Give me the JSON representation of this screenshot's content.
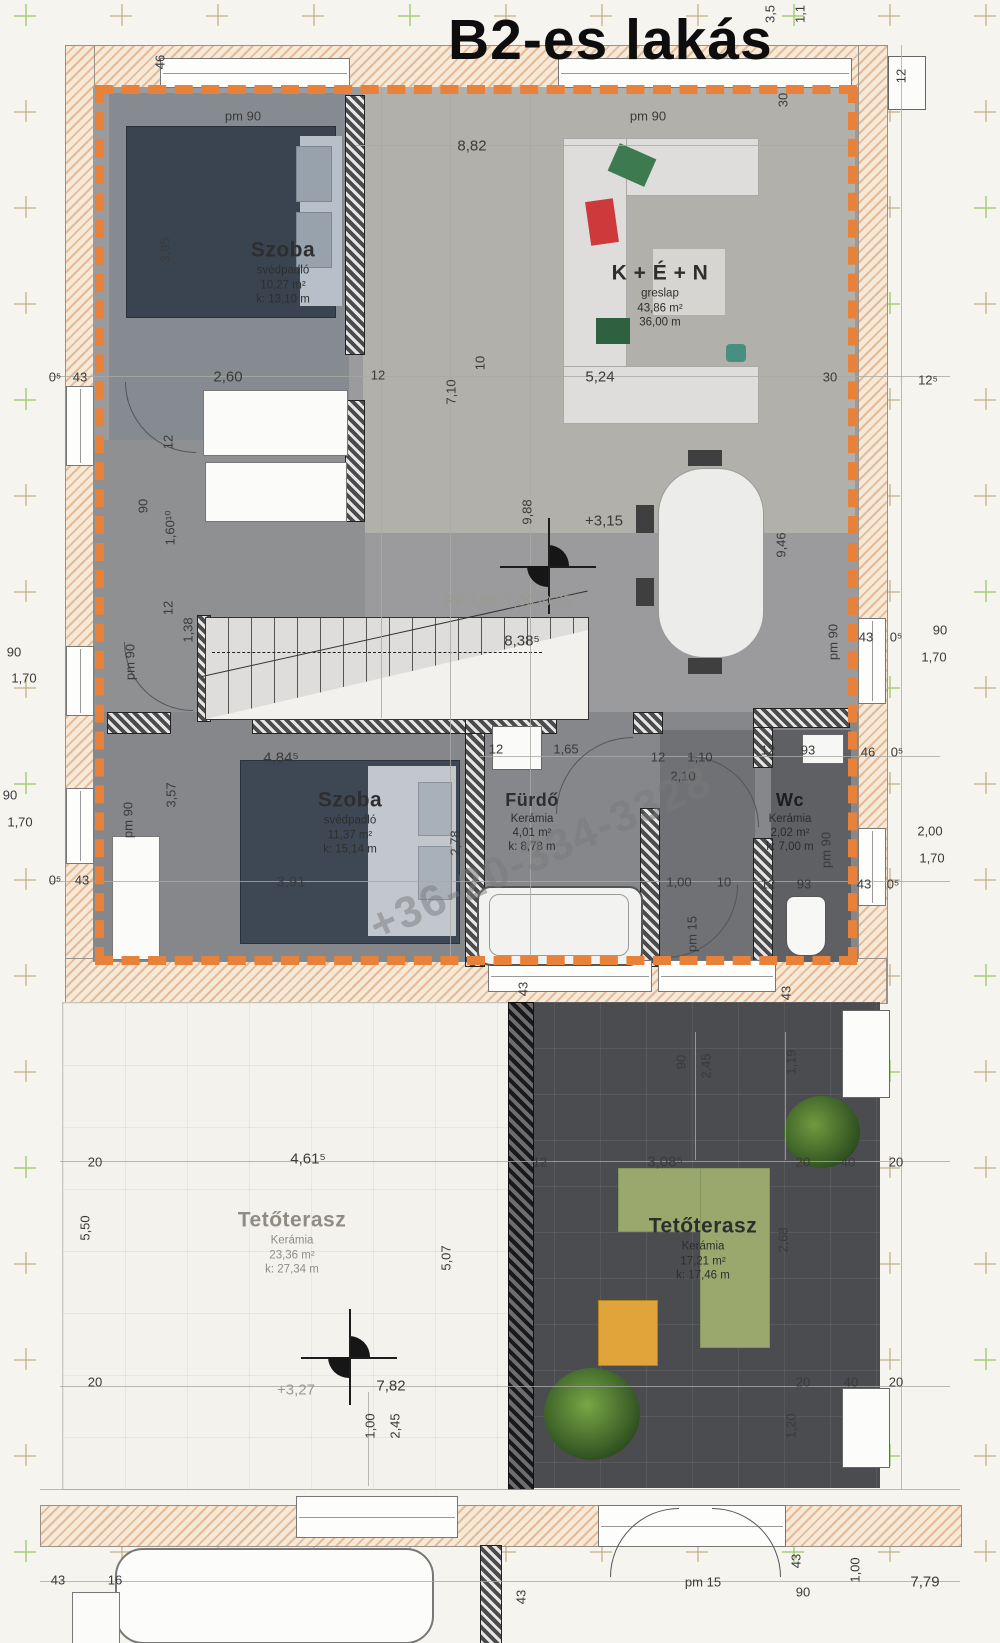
{
  "title": "B2-es lakás",
  "watermark": "+36-20-334-3328",
  "rooms": {
    "szoba1": {
      "name": "Szoba",
      "floor": "svédpadló",
      "area": "10,27 m²",
      "perimeter": "k:  13,10 m"
    },
    "ken": {
      "name": "K + É + N",
      "floor": "greslap",
      "area": "43,86 m²",
      "perimeter": "36,00 m"
    },
    "szoba2": {
      "name": "Szoba",
      "floor": "svédpadló",
      "area": "11,37 m²",
      "perimeter": "k:  15,14 m"
    },
    "furdo": {
      "name": "Fürdő",
      "floor": "Kerámia",
      "area": "4,01 m²",
      "perimeter": "k:  8,78 m"
    },
    "wc": {
      "name": "Wc",
      "floor": "Kerámia",
      "area": "2,02 m²",
      "perimeter": "k:  7,00 m"
    },
    "terasz1": {
      "name": "Tetőterasz",
      "floor": "Kerámia",
      "area": "23,36 m²",
      "perimeter": "k:  27,34 m"
    },
    "terasz2": {
      "name": "Tetőterasz",
      "floor": "Kerámia",
      "area": "17,21 m²",
      "perimeter": "k:  17,46 m"
    }
  },
  "colors": {
    "accent_border": "#e8813a",
    "wall_hatch": "#e4ba97",
    "terrace_dark": "#4b4c50",
    "bed_dark": "#3a4450"
  },
  "dims": [
    {
      "t": "46",
      "x": 160,
      "y": 62,
      "r": 1
    },
    {
      "t": "3,5",
      "x": 770,
      "y": 14,
      "r": 1
    },
    {
      "t": "1,1",
      "x": 800,
      "y": 14,
      "r": 1
    },
    {
      "t": "30",
      "x": 783,
      "y": 100,
      "r": 1
    },
    {
      "t": "12",
      "x": 901,
      "y": 76,
      "r": 1
    },
    {
      "t": "pm 90",
      "x": 243,
      "y": 116
    },
    {
      "t": "pm 90",
      "x": 648,
      "y": 116
    },
    {
      "t": "8,82",
      "x": 472,
      "y": 146,
      "c": "big"
    },
    {
      "t": "3,95",
      "x": 165,
      "y": 250,
      "r": 1
    },
    {
      "t": "0⁵",
      "x": 55,
      "y": 377
    },
    {
      "t": "43",
      "x": 80,
      "y": 377
    },
    {
      "t": "2,60",
      "x": 228,
      "y": 377,
      "c": "big"
    },
    {
      "t": "12",
      "x": 378,
      "y": 375
    },
    {
      "t": "10",
      "x": 480,
      "y": 363,
      "r": 1
    },
    {
      "t": "7,10",
      "x": 451,
      "y": 392,
      "r": 1
    },
    {
      "t": "5,24",
      "x": 600,
      "y": 377,
      "c": "big"
    },
    {
      "t": "30",
      "x": 830,
      "y": 377
    },
    {
      "t": "12⁵",
      "x": 928,
      "y": 380
    },
    {
      "t": "12",
      "x": 168,
      "y": 442,
      "r": 1
    },
    {
      "t": "90",
      "x": 143,
      "y": 506,
      "r": 1
    },
    {
      "t": "1,60¹⁰",
      "x": 170,
      "y": 528,
      "r": 1
    },
    {
      "t": "12",
      "x": 168,
      "y": 608,
      "r": 1
    },
    {
      "t": "pm 90",
      "x": 130,
      "y": 662,
      "r": 1
    },
    {
      "t": "9,88",
      "x": 527,
      "y": 512,
      "r": 1
    },
    {
      "t": "+3,15",
      "x": 604,
      "y": 521,
      "c": "big"
    },
    {
      "t": "9,46",
      "x": 781,
      "y": 545,
      "r": 1
    },
    {
      "t": "PF 4,25 /1,00 /0,35",
      "x": 508,
      "y": 601,
      "c": "ghost"
    },
    {
      "t": "8,38⁵",
      "x": 522,
      "y": 641,
      "c": "big"
    },
    {
      "t": "1,38",
      "x": 188,
      "y": 630,
      "r": 1
    },
    {
      "t": "90",
      "x": 14,
      "y": 652
    },
    {
      "t": "1,70",
      "x": 24,
      "y": 678
    },
    {
      "t": "90",
      "x": 10,
      "y": 795
    },
    {
      "t": "1,70",
      "x": 20,
      "y": 822
    },
    {
      "t": "0⁵",
      "x": 55,
      "y": 880
    },
    {
      "t": "43",
      "x": 82,
      "y": 880
    },
    {
      "t": "43",
      "x": 866,
      "y": 637
    },
    {
      "t": "0⁵",
      "x": 896,
      "y": 637
    },
    {
      "t": "90",
      "x": 940,
      "y": 630
    },
    {
      "t": "1,70",
      "x": 934,
      "y": 657
    },
    {
      "t": "pm 90",
      "x": 833,
      "y": 642,
      "r": 1
    },
    {
      "t": "12",
      "x": 768,
      "y": 750
    },
    {
      "t": "93",
      "x": 808,
      "y": 750
    },
    {
      "t": "46",
      "x": 868,
      "y": 752
    },
    {
      "t": "0⁵",
      "x": 897,
      "y": 752
    },
    {
      "t": "2,00",
      "x": 930,
      "y": 831
    },
    {
      "t": "1,70",
      "x": 932,
      "y": 858
    },
    {
      "t": "pm 90",
      "x": 826,
      "y": 850,
      "r": 1
    },
    {
      "t": "12",
      "x": 768,
      "y": 884
    },
    {
      "t": "93",
      "x": 804,
      "y": 884
    },
    {
      "t": "43",
      "x": 864,
      "y": 884
    },
    {
      "t": "0⁵",
      "x": 893,
      "y": 884
    },
    {
      "t": "12",
      "x": 496,
      "y": 749
    },
    {
      "t": "1,65",
      "x": 566,
      "y": 749
    },
    {
      "t": "12",
      "x": 658,
      "y": 757
    },
    {
      "t": "1,10",
      "x": 700,
      "y": 757
    },
    {
      "t": "2,10",
      "x": 683,
      "y": 776
    },
    {
      "t": "4,84⁵",
      "x": 281,
      "y": 758,
      "c": "big"
    },
    {
      "t": "3,57",
      "x": 171,
      "y": 795,
      "r": 1
    },
    {
      "t": "pm 90",
      "x": 128,
      "y": 820,
      "r": 1
    },
    {
      "t": "2,78",
      "x": 455,
      "y": 843,
      "r": 1
    },
    {
      "t": "3,91",
      "x": 291,
      "y": 882,
      "c": "big"
    },
    {
      "t": "1,00",
      "x": 679,
      "y": 882
    },
    {
      "t": "10",
      "x": 724,
      "y": 882
    },
    {
      "t": "pm 15",
      "x": 692,
      "y": 934,
      "r": 1
    },
    {
      "t": "43",
      "x": 523,
      "y": 989,
      "r": 1
    },
    {
      "t": "43",
      "x": 786,
      "y": 993,
      "r": 1
    },
    {
      "t": "20",
      "x": 95,
      "y": 1162
    },
    {
      "t": "4,61⁵",
      "x": 308,
      "y": 1159,
      "c": "big"
    },
    {
      "t": "12",
      "x": 540,
      "y": 1162
    },
    {
      "t": "5,50",
      "x": 85,
      "y": 1228,
      "r": 1
    },
    {
      "t": "5,07",
      "x": 446,
      "y": 1258,
      "r": 1
    },
    {
      "t": "20",
      "x": 95,
      "y": 1382
    },
    {
      "t": "+3,27",
      "x": 296,
      "y": 1390,
      "c": "ghost"
    },
    {
      "t": "7,82",
      "x": 391,
      "y": 1386,
      "c": "big"
    },
    {
      "t": "1,00",
      "x": 370,
      "y": 1426,
      "r": 1
    },
    {
      "t": "2,45",
      "x": 395,
      "y": 1426,
      "r": 1
    },
    {
      "t": "90",
      "x": 681,
      "y": 1062,
      "r": 1
    },
    {
      "t": "2,45",
      "x": 706,
      "y": 1066,
      "r": 1
    },
    {
      "t": "1,19",
      "x": 791,
      "y": 1062,
      "r": 1
    },
    {
      "t": "3,08⁵",
      "x": 665,
      "y": 1162,
      "c": "big"
    },
    {
      "t": "20",
      "x": 803,
      "y": 1162
    },
    {
      "t": "40",
      "x": 848,
      "y": 1162
    },
    {
      "t": "20",
      "x": 896,
      "y": 1162
    },
    {
      "t": "2,68",
      "x": 783,
      "y": 1240,
      "r": 1
    },
    {
      "t": "20",
      "x": 803,
      "y": 1382
    },
    {
      "t": "40",
      "x": 851,
      "y": 1382
    },
    {
      "t": "20",
      "x": 896,
      "y": 1382
    },
    {
      "t": "1,20",
      "x": 791,
      "y": 1426,
      "r": 1
    },
    {
      "t": "43",
      "x": 58,
      "y": 1580
    },
    {
      "t": "16",
      "x": 115,
      "y": 1580
    },
    {
      "t": "pm 15",
      "x": 703,
      "y": 1582
    },
    {
      "t": "90",
      "x": 803,
      "y": 1592
    },
    {
      "t": "1,00",
      "x": 855,
      "y": 1570,
      "r": 1
    },
    {
      "t": "7,79",
      "x": 925,
      "y": 1582,
      "c": "big"
    },
    {
      "t": "43",
      "x": 521,
      "y": 1597,
      "r": 1
    },
    {
      "t": "43",
      "x": 796,
      "y": 1561,
      "r": 1
    }
  ]
}
